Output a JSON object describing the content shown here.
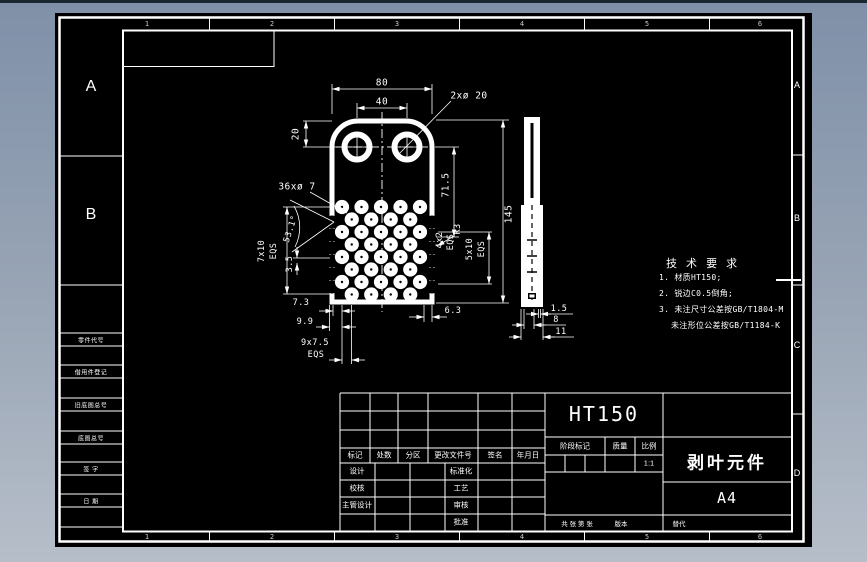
{
  "window": {
    "bg_top": "#7f90a8",
    "bg_bottom": "#b6bec9",
    "edge": "#1c2631"
  },
  "sheet": {
    "bg": "#000000",
    "line_color": "#ffffff"
  },
  "zones": {
    "top_numbers": [
      "1",
      "2",
      "3",
      "4",
      "5",
      "6"
    ],
    "bottom_numbers": [
      "1",
      "2",
      "3",
      "4",
      "5",
      "6"
    ],
    "left_letters": [
      "A",
      "B"
    ],
    "right_letters": [
      "A",
      "B",
      "C",
      "D"
    ]
  },
  "margin_table": {
    "rows": [
      "零件代号",
      "借用件登记",
      "旧底图总号",
      "底图总号",
      "签 字",
      "日 期"
    ]
  },
  "tech_req": {
    "title": "技 术 要 求",
    "lines": [
      "1. 材质HT150;",
      "2. 锐边C0.5倒角;",
      "3. 未注尺寸公差按GB/T1804-M",
      "未注形位公差按GB/T1184-K"
    ]
  },
  "dims": {
    "width": "80",
    "inner": "40",
    "holes_top": "2xø 20",
    "top_offset": "20",
    "v715": "71.5",
    "height": "145",
    "small_holes": "36xø 7",
    "angle": "53.1°",
    "rows": "7x10",
    "eqs": "EQS",
    "d35": "3.5",
    "d73": "7.3",
    "d99": "9.9",
    "cols": "9x7.5",
    "d63": "6.3",
    "r3": "R3",
    "notch": "4x2",
    "notch_sp": "5x10",
    "t15": "1.5",
    "t8": "8",
    "t11": "11"
  },
  "title_block": {
    "header": [
      "标记",
      "处数",
      "分区",
      "更改文件号",
      "签名",
      "年月日"
    ],
    "sign_rows": [
      "设计",
      "校核",
      "主管设计"
    ],
    "approve_rows": [
      "标准化",
      "工艺",
      "审核",
      "批准"
    ],
    "material": "HT150",
    "stage_label": "阶段标记",
    "mass_label": "质量",
    "scale_label": "比例",
    "scale_value": "1:1",
    "part_name": "剥叶元件",
    "sheet_size": "A4",
    "bottom": [
      "共 张 第 张",
      "版本",
      "替代"
    ]
  },
  "cursor": {
    "type": "crosshair"
  }
}
